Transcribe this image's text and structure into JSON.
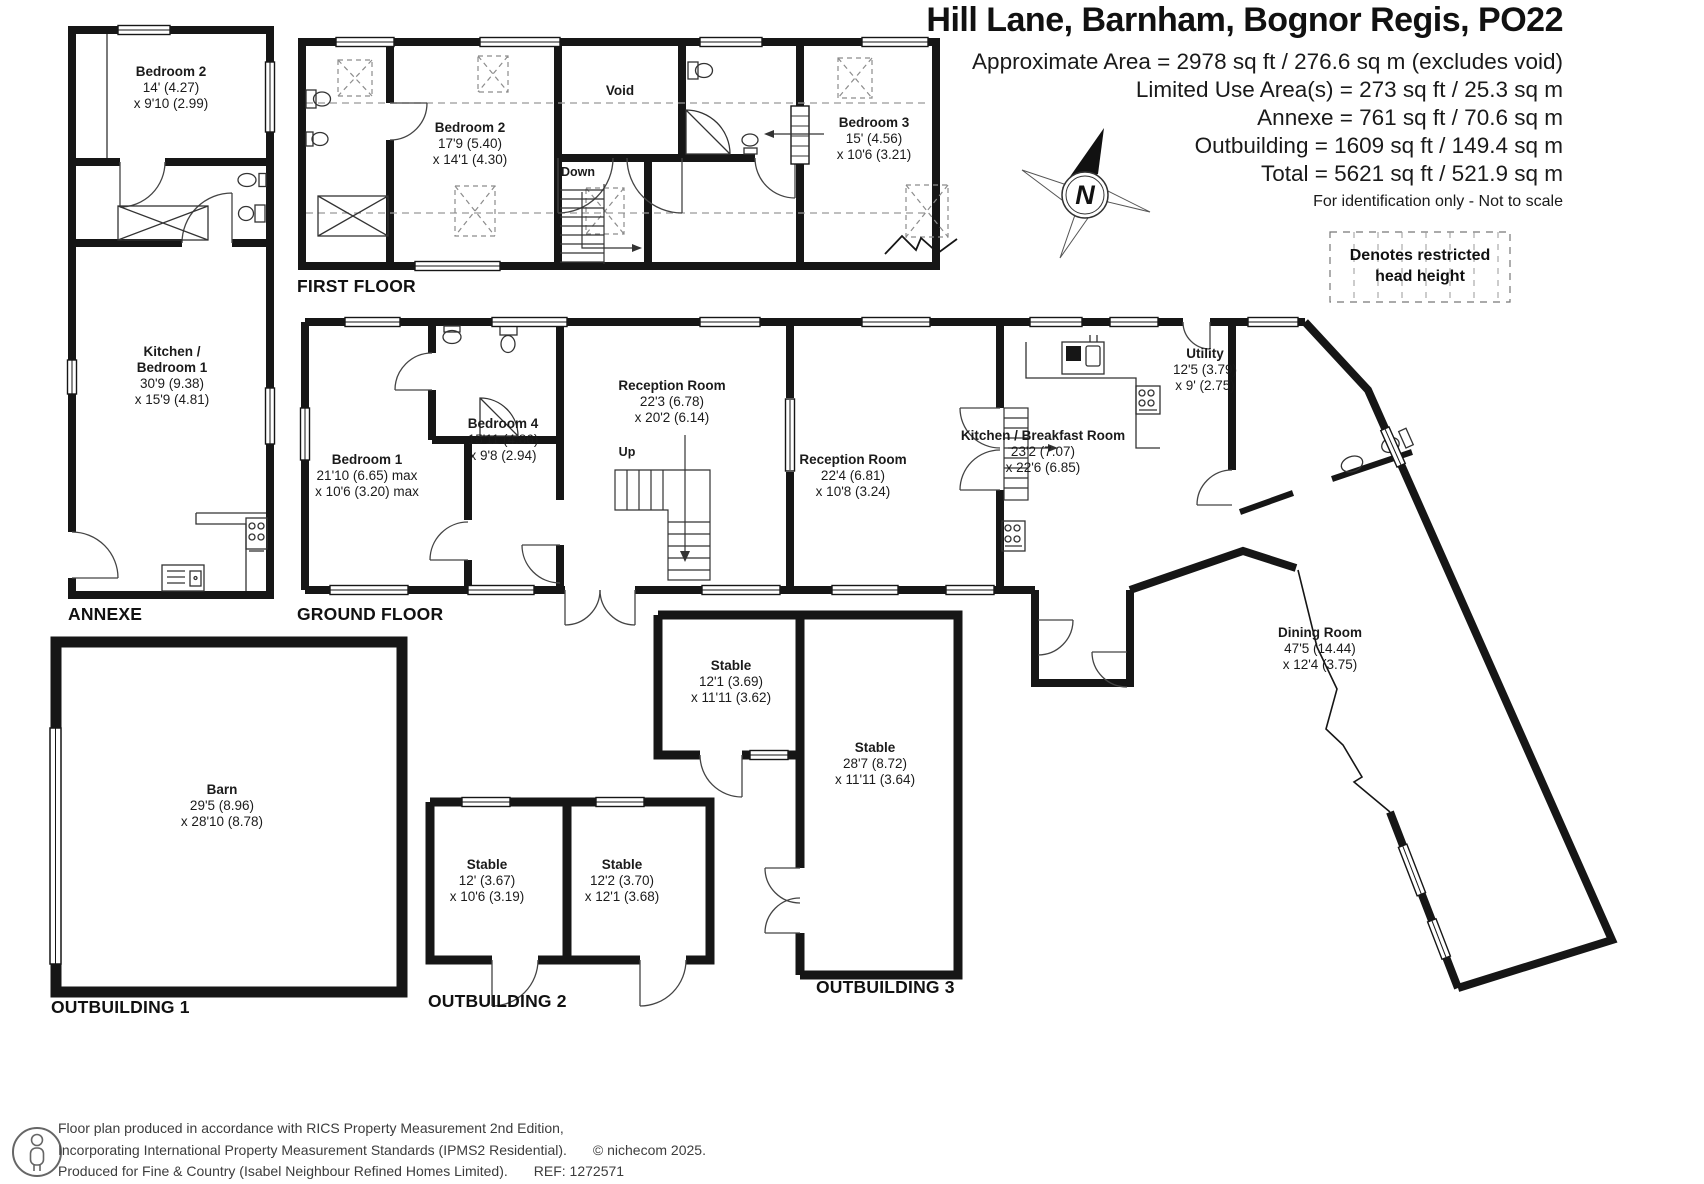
{
  "header": {
    "title": "Hill Lane, Barnham, Bognor Regis, PO22",
    "area_lines": [
      "Approximate Area = 2978 sq ft / 276.6 sq m (excludes void)",
      "Limited Use Area(s) = 273 sq ft / 25.3 sq m",
      "Annexe = 761 sq ft / 70.6 sq m",
      "Outbuilding = 1609 sq ft / 149.4 sq m",
      "Total = 5621 sq ft / 521.9 sq m"
    ],
    "note": "For identification only - Not to scale",
    "compass": "N"
  },
  "legend": {
    "line1": "Denotes restricted",
    "line2": "head height"
  },
  "sections": {
    "first_floor": "FIRST FLOOR",
    "annexe": "ANNEXE",
    "ground_floor": "GROUND FLOOR",
    "outbuilding1": "OUTBUILDING 1",
    "outbuilding2": "OUTBUILDING 2",
    "outbuilding3": "OUTBUILDING 3"
  },
  "rooms": [
    {
      "id": "annexe-bedroom2",
      "lines": [
        "Bedroom 2",
        "14' (4.27)",
        "x 9'10 (2.99)"
      ]
    },
    {
      "id": "annexe-kitchen",
      "lines": [
        "Kitchen /",
        "Bedroom 1",
        "30'9 (9.38)",
        "x 15'9 (4.81)"
      ]
    },
    {
      "id": "ff-bedroom2",
      "lines": [
        "Bedroom 2",
        "17'9 (5.40)",
        "x 14'1 (4.30)"
      ]
    },
    {
      "id": "ff-bedroom3",
      "lines": [
        "Bedroom 3",
        "15' (4.56)",
        "x 10'6 (3.21)"
      ]
    },
    {
      "id": "gf-bedroom1",
      "lines": [
        "Bedroom 1",
        "21'10 (6.65) max",
        "x 10'6 (3.20) max"
      ]
    },
    {
      "id": "gf-bedroom4",
      "lines": [
        "Bedroom 4",
        "15'11 (4.86)",
        "x 9'8 (2.94)"
      ]
    },
    {
      "id": "gf-reception1",
      "lines": [
        "Reception Room",
        "22'3 (6.78)",
        "x 20'2 (6.14)"
      ]
    },
    {
      "id": "gf-reception2",
      "lines": [
        "Reception Room",
        "22'4 (6.81)",
        "x 10'8 (3.24)"
      ]
    },
    {
      "id": "gf-kitchen",
      "lines": [
        "Kitchen / Breakfast Room",
        "23'2 (7.07)",
        "x 22'6 (6.85)"
      ]
    },
    {
      "id": "gf-utility",
      "lines": [
        "Utility",
        "12'5 (3.79)",
        "x 9' (2.75)"
      ]
    },
    {
      "id": "dining-room",
      "lines": [
        "Dining Room",
        "47'5 (14.44)",
        "x 12'4 (3.75)"
      ]
    },
    {
      "id": "barn",
      "lines": [
        "Barn",
        "29'5 (8.96)",
        "x 28'10 (8.78)"
      ]
    },
    {
      "id": "ob3-stable-small",
      "lines": [
        "Stable",
        "12'1 (3.69)",
        "x 11'11 (3.62)"
      ]
    },
    {
      "id": "ob3-stable-large",
      "lines": [
        "Stable",
        "28'7 (8.72)",
        "x 11'11 (3.64)"
      ]
    },
    {
      "id": "ob2-stable-left",
      "lines": [
        "Stable",
        "12' (3.67)",
        "x 10'6 (3.19)"
      ]
    },
    {
      "id": "ob2-stable-right",
      "lines": [
        "Stable",
        "12'2 (3.70)",
        "x 12'1 (3.68)"
      ]
    }
  ],
  "annotations": {
    "void": "Void",
    "down": "Down",
    "up": "Up"
  },
  "footer": {
    "line1": "Floor plan produced in accordance with RICS Property Measurement 2nd Edition,",
    "line2": "Incorporating International Property Measurement Standards (IPMS2 Residential).",
    "copyright": "© nichecom 2025.",
    "line3": "Produced for Fine & Country (Isabel Neighbour Refined Homes Limited).",
    "ref": "REF: 1272571"
  },
  "colors": {
    "wall": "#161616",
    "detail": "#3a3a3a",
    "dashed": "#8c8c8c"
  }
}
